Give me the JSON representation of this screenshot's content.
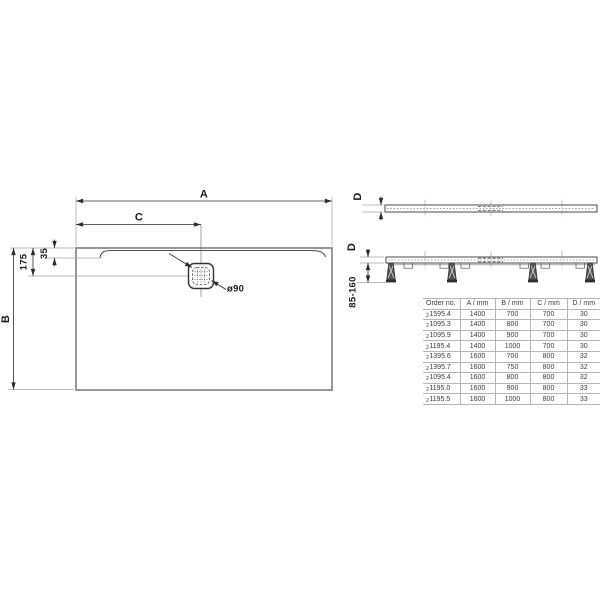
{
  "colors": {
    "tray_outline": "#8c8c8c",
    "drawing_line": "#4a4a4a",
    "dimension_line": "#2b2b2b",
    "table_border": "#b7b7b7",
    "text": "#1a1a1a"
  },
  "plan_view": {
    "width_label": "A",
    "depth_label": "B",
    "drain_offset_label": "C",
    "drain_center_inset": "175",
    "channel_inset": "35",
    "drain_diameter": "ø90"
  },
  "profile_view": {
    "thickness_label": "D"
  },
  "installed_view": {
    "thickness_label": "D",
    "install_height_range": "85-160"
  },
  "table": {
    "headers": [
      "Order no.",
      "A / mm",
      "B / mm",
      "C / mm",
      "D / mm"
    ],
    "rows": [
      {
        "prefix": "2",
        "order": "1595.4",
        "a": "1400",
        "b": "700",
        "c": "700",
        "d": "30"
      },
      {
        "prefix": "2",
        "order": "1095.3",
        "a": "1400",
        "b": "800",
        "c": "700",
        "d": "30"
      },
      {
        "prefix": "2",
        "order": "1095.9",
        "a": "1400",
        "b": "900",
        "c": "700",
        "d": "30"
      },
      {
        "prefix": "2",
        "order": "1195.4",
        "a": "1400",
        "b": "1000",
        "c": "700",
        "d": "30"
      },
      {
        "prefix": "2",
        "order": "1395.6",
        "a": "1600",
        "b": "700",
        "c": "800",
        "d": "32"
      },
      {
        "prefix": "2",
        "order": "1395.7",
        "a": "1600",
        "b": "750",
        "c": "800",
        "d": "32"
      },
      {
        "prefix": "2",
        "order": "1095.4",
        "a": "1600",
        "b": "800",
        "c": "800",
        "d": "32"
      },
      {
        "prefix": "2",
        "order": "1195.0",
        "a": "1600",
        "b": "900",
        "c": "800",
        "d": "33"
      },
      {
        "prefix": "2",
        "order": "1195.5",
        "a": "1600",
        "b": "1000",
        "c": "800",
        "d": "33"
      }
    ]
  }
}
